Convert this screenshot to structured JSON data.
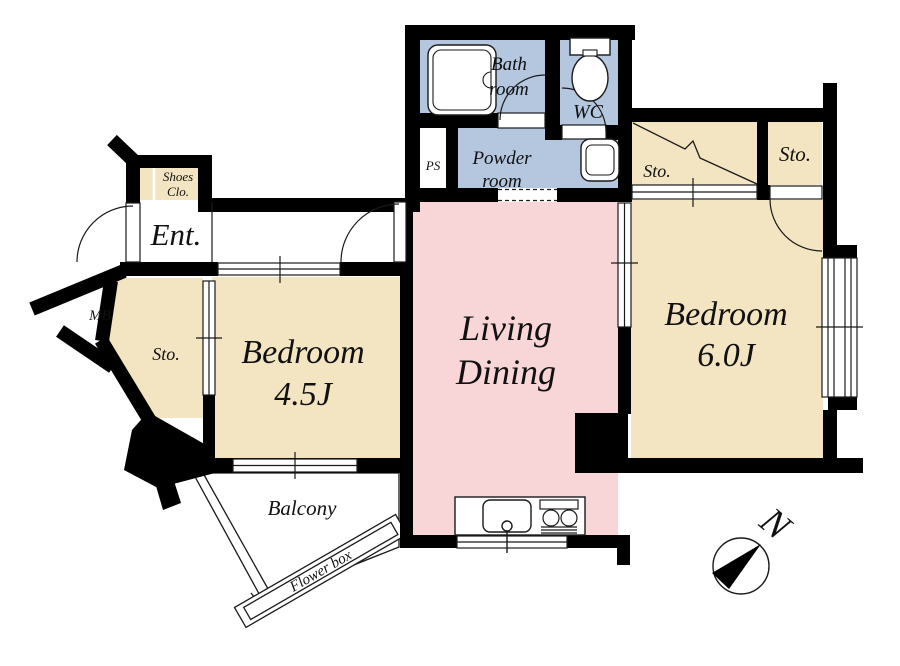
{
  "plan_title": "1LDK apartment floor plan",
  "colors": {
    "wall": "#000000",
    "tan": "#f3e5c2",
    "blue": "#b5c6df",
    "pink": "#f8d6d8",
    "line": "#1a1a1a",
    "bg": "#ffffff"
  },
  "labels": {
    "bath_1": "Bath",
    "bath_2": "room",
    "wc": "WC",
    "powder_1": "Powder",
    "powder_2": "room",
    "ps": "PS",
    "shoes_1": "Shoes",
    "shoes_2": "Clo.",
    "entrance": "Ent.",
    "mb": "MB",
    "storage_west": "Sto.",
    "bedroom_west_1": "Bedroom",
    "bedroom_west_2": "4.5J",
    "living_1": "Living",
    "living_2": "Dining",
    "bedroom_east_1": "Bedroom",
    "bedroom_east_2": "6.0J",
    "storage_east_wide": "Sto.",
    "storage_east_small": "Sto.",
    "balcony": "Balcony",
    "flower_box": "Flower box",
    "compass_north": "N"
  }
}
